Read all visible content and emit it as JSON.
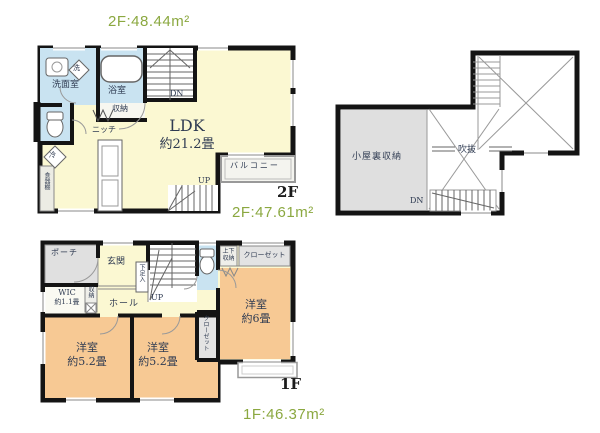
{
  "labels": {
    "floor2_area_top": "2F:48.44m²",
    "floor2_area": "2F:47.61m²",
    "floor1_area": "1F:46.37m²",
    "floor2_mark": "2F",
    "floor1_mark": "1F"
  },
  "floor2": {
    "washroom": "洗面室",
    "washer": "洗",
    "bathroom": "浴室",
    "storage": "収納",
    "stairs_dn": "DN",
    "niche": "ニッチ",
    "ldk_name": "LDK",
    "ldk_size": "約21.2畳",
    "fridge": "冷",
    "cupboard": "食器棚",
    "balcony": "バルコニー",
    "stairs_up": "UP"
  },
  "attic": {
    "attic_storage": "小屋裏収納",
    "void": "吹抜",
    "stairs_dn": "DN"
  },
  "floor1": {
    "porch": "ポーチ",
    "entrance": "玄関",
    "shoe_cabinet": "下足入",
    "stairs_up": "UP",
    "upper_storage": "上下収納",
    "closet": "クローゼット",
    "wic_name": "WIC",
    "wic_size": "約1.1畳",
    "storage": "収納",
    "hall": "ホール",
    "bedroom_6": {
      "name": "洋室",
      "size": "約6畳"
    },
    "bedroom_52_left": {
      "name": "洋室",
      "size": "約5.2畳"
    },
    "bedroom_52_mid": {
      "name": "洋室",
      "size": "約5.2畳"
    },
    "closet_vertical": "クローゼット"
  },
  "colors": {
    "room_yellow": "#FBF8D2",
    "wet_blue": "#C9E3F1",
    "bedroom_orange": "#F7C994",
    "attic_gray": "#DFDFDF",
    "closet_gray": "#E3E3E3",
    "wall": "#141414",
    "green_text": "#8BA840",
    "plan_text": "#2F3B52"
  }
}
